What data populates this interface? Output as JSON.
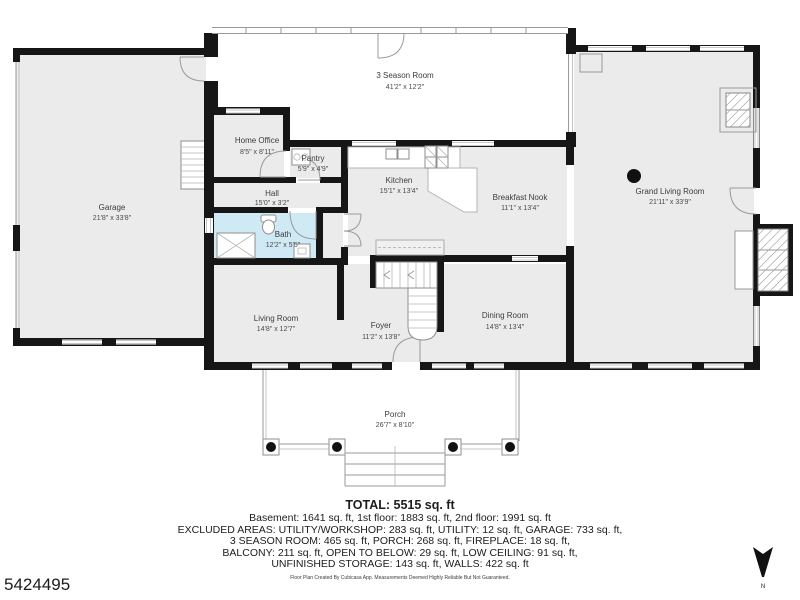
{
  "plan": {
    "rooms": [
      {
        "id": "three-season-room",
        "name": "3 Season Room",
        "dims": "41'2\" x 12'2\""
      },
      {
        "id": "home-office",
        "name": "Home Office",
        "dims": "8'5\" x 8'11\""
      },
      {
        "id": "pantry",
        "name": "Pantry",
        "dims": "5'9\" x 4'9\""
      },
      {
        "id": "hall",
        "name": "Hall",
        "dims": "15'0\" x 3'2\""
      },
      {
        "id": "kitchen",
        "name": "Kitchen",
        "dims": "15'1\" x 13'4\""
      },
      {
        "id": "breakfast-nook",
        "name": "Breakfast Nook",
        "dims": "11'1\" x 13'4\""
      },
      {
        "id": "grand-living-room",
        "name": "Grand Living Room",
        "dims": "21'11\" x 33'9\""
      },
      {
        "id": "garage",
        "name": "Garage",
        "dims": "21'8\" x 33'8\""
      },
      {
        "id": "bath",
        "name": "Bath",
        "dims": "12'2\" x 5'5\""
      },
      {
        "id": "living-room",
        "name": "Living Room",
        "dims": "14'8\" x 12'7\""
      },
      {
        "id": "foyer",
        "name": "Foyer",
        "dims": "11'2\" x 13'8\""
      },
      {
        "id": "dining-room",
        "name": "Dining Room",
        "dims": "14'8\" x 13'4\""
      },
      {
        "id": "porch",
        "name": "Porch",
        "dims": "26'7\" x 8'10\""
      }
    ],
    "compass_label": "N",
    "colors": {
      "wall": "#161616",
      "room_fill": "#ebebeb",
      "bath_fill": "#cfe9f5",
      "thin_line": "#9a9a9a"
    }
  },
  "summary": {
    "total": "TOTAL: 5515 sq. ft",
    "line1": "Basement: 1641 sq. ft, 1st floor: 1883 sq. ft, 2nd floor: 1991 sq. ft",
    "line2": "EXCLUDED AREAS: UTILITY/WORKSHOP: 283 sq. ft, UTILITY: 12 sq. ft, GARAGE: 733 sq. ft,",
    "line3": "3 SEASON ROOM: 465 sq. ft, PORCH: 268 sq. ft, FIREPLACE: 18 sq. ft,",
    "line4": "BALCONY: 211 sq. ft, OPEN TO BELOW: 29 sq. ft, LOW CEILING: 91 sq. ft,",
    "line5": "UNFINISHED STORAGE: 143 sq. ft, WALLS: 422 sq. ft",
    "disclaimer": "Floor Plan Created By Cubicasa App. Measurements Deemed Highly Reliable But Not Guaranteed."
  },
  "listing_id": "5424495"
}
